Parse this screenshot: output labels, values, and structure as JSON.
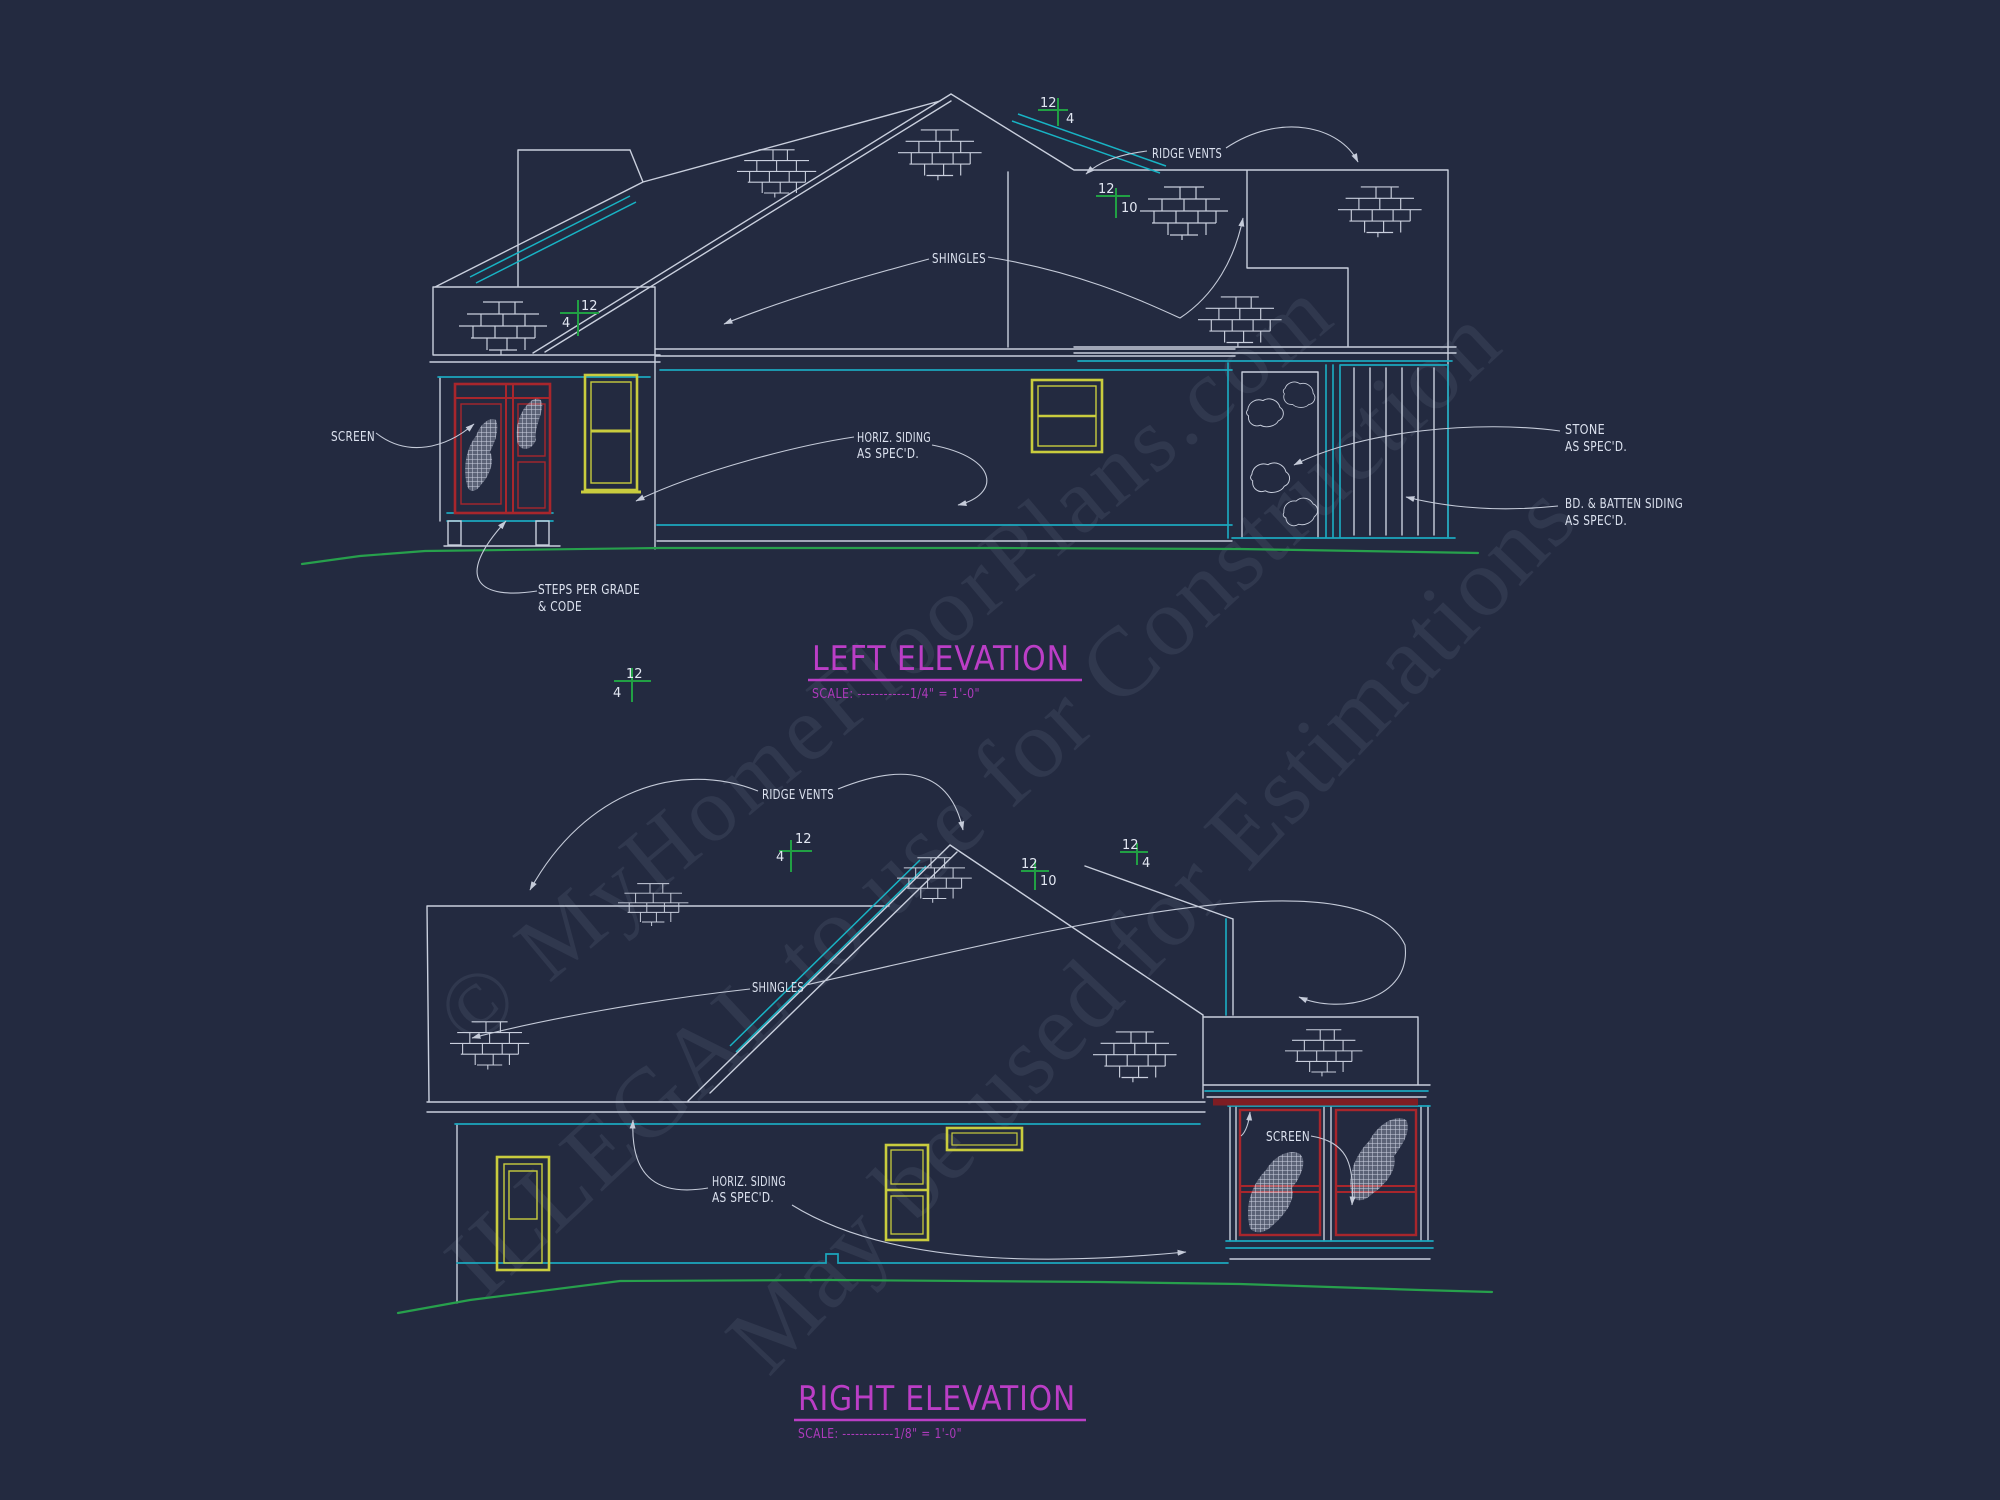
{
  "background": "#232a40",
  "colors": {
    "line": "#c9cfdd",
    "text": "#dce2ef",
    "cyan_trim": "#1ba7bd",
    "green_grade": "#27a04c",
    "yellow_window": "#c9cc3e",
    "red_screen": "#a8262c",
    "magenta_title": "#bb3ec6",
    "watermark": "#b9c3e0"
  },
  "watermarks": [
    "© MyHomeFloorPlans.com",
    "ILLEGAL to use for Construction",
    "May be used for Estimations"
  ],
  "left_elevation": {
    "title": "LEFT ELEVATION",
    "scale": "SCALE: ------------1/4\" = 1'-0\"",
    "labels": {
      "ridge_vents": "RIDGE VENTS",
      "shingles": "SHINGLES",
      "screen": "SCREEN",
      "horiz_siding_line1": "HORIZ. SIDING",
      "horiz_siding_line2": "AS SPEC'D.",
      "steps_line1": "STEPS PER GRADE",
      "steps_line2": "& CODE",
      "stone_line1": "STONE",
      "stone_line2": "AS SPEC'D.",
      "batten_line1": "BD. & BATTEN SIDING",
      "batten_line2": "AS SPEC'D."
    },
    "pitch_markers": [
      {
        "rise": "12",
        "run": "4"
      },
      {
        "rise": "12",
        "run": "4"
      },
      {
        "rise": "12",
        "run": "10"
      }
    ]
  },
  "right_elevation": {
    "title": "RIGHT ELEVATION",
    "scale": "SCALE: ------------1/8\" = 1'-0\"",
    "labels": {
      "ridge_vents": "RIDGE VENTS",
      "shingles": "SHINGLES",
      "screen": "SCREEN",
      "horiz_siding_line1": "HORIZ. SIDING",
      "horiz_siding_line2": "AS SPEC'D."
    },
    "pitch_markers": [
      {
        "rise": "12",
        "run": "4"
      },
      {
        "rise": "12",
        "run": "4"
      },
      {
        "rise": "12",
        "run": "10"
      },
      {
        "rise": "12",
        "run": "4"
      }
    ]
  }
}
